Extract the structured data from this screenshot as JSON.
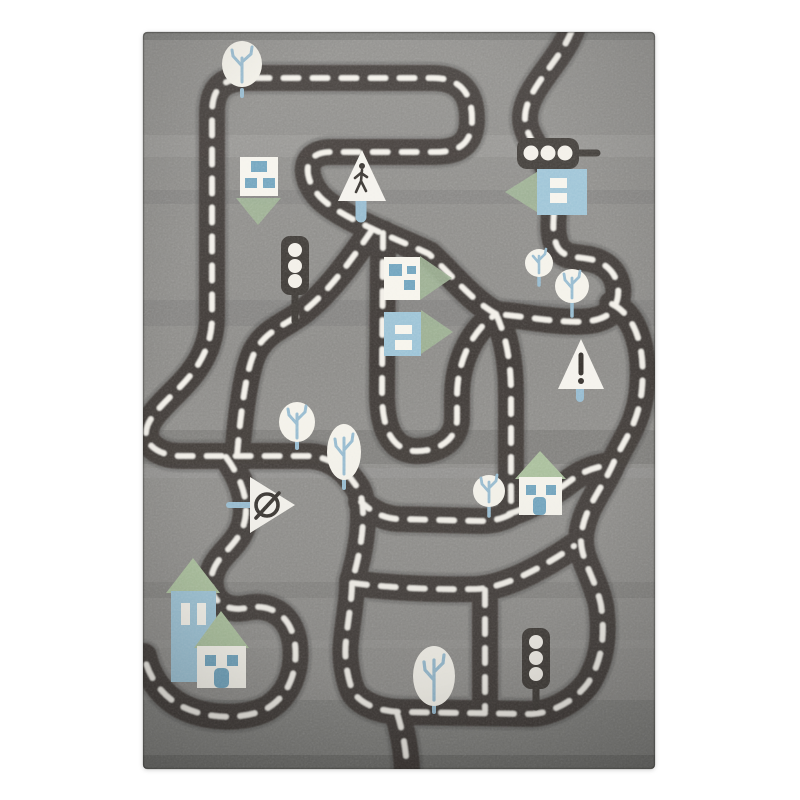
{
  "meta": {
    "type": "product-photo",
    "subject": "children's road play rug",
    "description": "Top-down photo of a grey kids' play rug decorated with winding dark roads with white dashed centre lines, small houses with green roofs, white trees with blue branches, traffic lights and road signs."
  },
  "scene": {
    "object_counts": {
      "trees": 7,
      "houses": 7,
      "traffic_lights": 3,
      "road_signs": 3
    },
    "signs": [
      "pedestrian-crossing",
      "warning-exclamation",
      "no-entry"
    ],
    "road_features": [
      "dashed-centre-lines",
      "loops",
      "junctions"
    ]
  },
  "palette": {
    "page_bg": "#ffffff",
    "rug_base": "#8d8c89",
    "rug_light": "#9d9c99",
    "rug_dark": "#767572",
    "road": "#3e3a36",
    "road_dash": "#f2efe8",
    "tree_white": "#f4f2ea",
    "branch_blue": "#95bacf",
    "house_white": "#f6f4ec",
    "house_blue": "#9cc3d6",
    "window_blue": "#6fa3bd",
    "roof_green": "#a9bf9b",
    "arrow_green": "#9db394",
    "sign_white": "#f4f2ec",
    "glyph_dark": "#36322e"
  }
}
